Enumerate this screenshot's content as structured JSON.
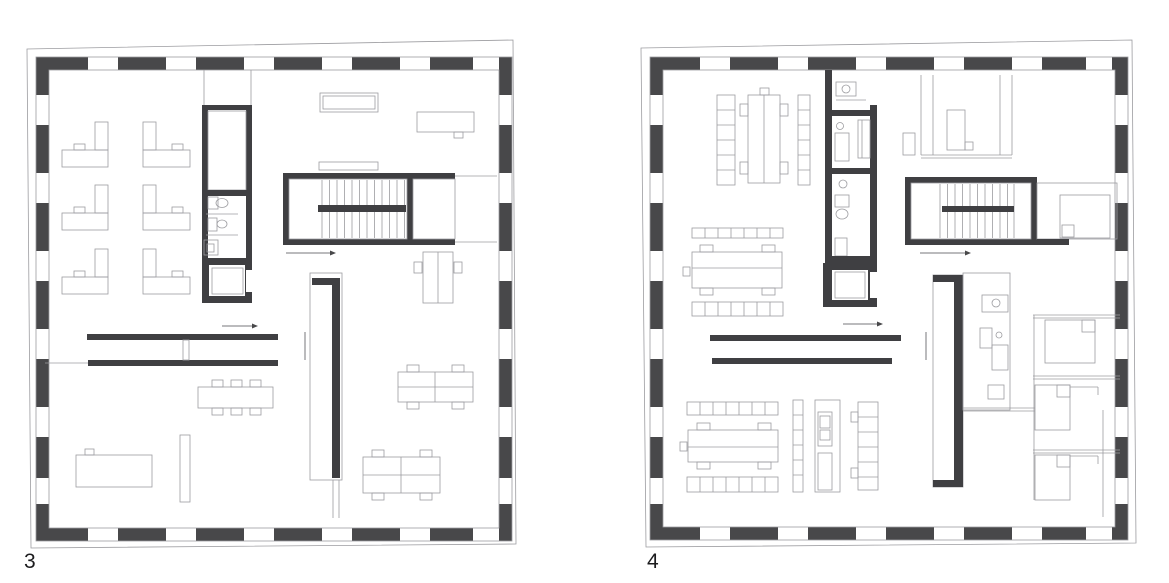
{
  "figure_labels": {
    "left_plan": "3",
    "right_plan": "4"
  },
  "plans": [
    {
      "label": "3",
      "elements": [
        "perimeter-pier-wall-with-windows",
        "outer-facade-outline",
        "service-core",
        "wc-toilet",
        "wc-sink",
        "elevator",
        "stairwell",
        "stair-landing",
        "stair-vestibule",
        "l-shaped-desks-grid-2x3",
        "sideboard",
        "wall-shelf",
        "desk-top-right",
        "desk-below-stair",
        "vertical-partition-wall",
        "double-partition-walls",
        "conference-table-six-chairs",
        "desk-bottom-left",
        "bench",
        "team-desk-a",
        "team-desk-b",
        "direction-arrows"
      ]
    },
    {
      "label": "4",
      "elements": [
        "perimeter-pier-wall-with-windows",
        "outer-facade-outline",
        "sanitary-core",
        "wc-1",
        "wc-2",
        "wc-3",
        "elevator",
        "stairwell",
        "stair-landing",
        "vertical-worktable-with-shelf-columns",
        "horizontal-worktable-with-shelf-rows-middle",
        "horizontal-worktable-with-shelf-rows-bottom",
        "shelf-strips",
        "appliance-unit",
        "double-partition-walls",
        "vertical-wall-channel",
        "wardrobe-room-top-right",
        "bedroom-beside-stair",
        "kitchenette-bath-unit",
        "bedroom-1",
        "bedroom-2",
        "bedroom-3",
        "direction-arrows"
      ]
    }
  ],
  "colors": {
    "background": "#ffffff",
    "pier": "#48484a",
    "wall": "#3f3f42",
    "line_medium": "#77777b",
    "line_thin": "#9c9ca0",
    "label_text": "#1c1c1e"
  }
}
